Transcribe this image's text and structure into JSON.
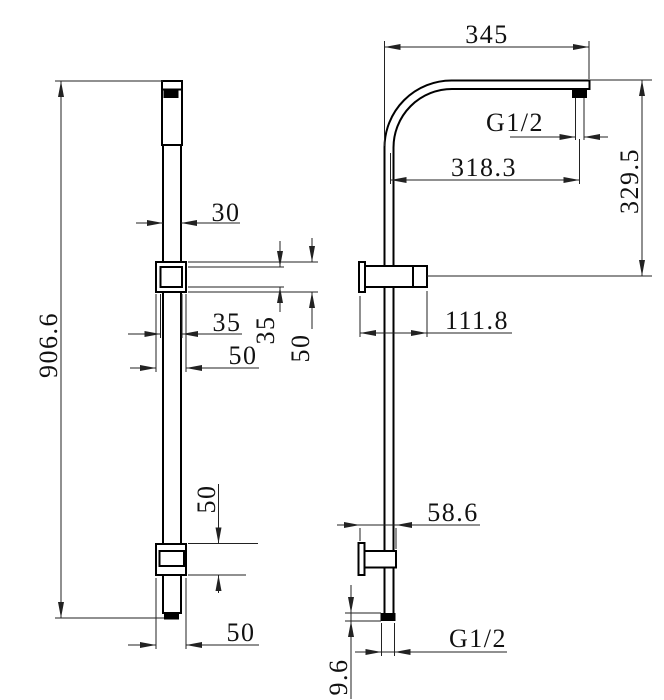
{
  "left_view": {
    "overall_height": "906.6",
    "rail_width": "30",
    "slider_inner_width": "35",
    "slider_outer_width": "50",
    "slider_inner_height": "35",
    "slider_outer_height": "50",
    "lower_bracket_height": "50",
    "lower_bracket_width": "50"
  },
  "right_view": {
    "arm_length": "345",
    "top_thread": "G1/2",
    "horizontal_reach": "318.3",
    "vertical_drop": "329.5",
    "upper_bracket_length": "111.8",
    "lower_bracket_length": "58.6",
    "bottom_thread": "G1/2",
    "inlet_cap_height": "9.6"
  },
  "colors": {
    "object_line": "#000000",
    "dimension_line": "#222222",
    "background": "#ffffff"
  }
}
